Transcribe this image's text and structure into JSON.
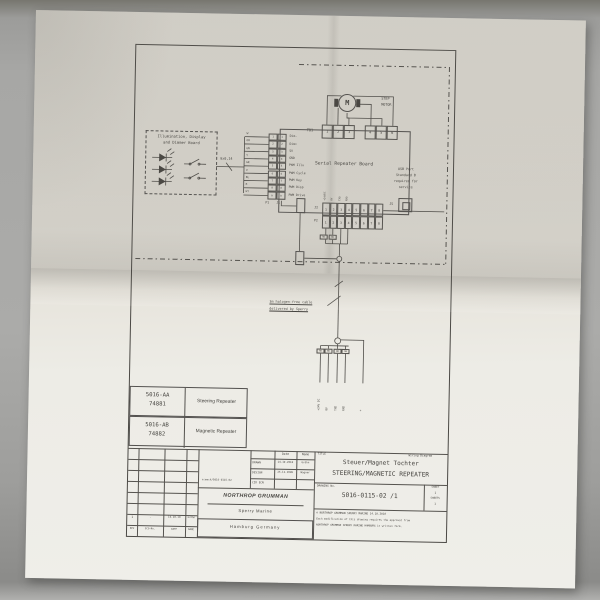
{
  "photo": {
    "desk_color": "#a7a7a5",
    "paper_color": "#e7e4dc",
    "ink_color": "#45433f"
  },
  "schematic": {
    "illumination_board_title_1": "Illumination, Display",
    "illumination_board_title_2": "and Dimmer Board",
    "cable_spec": "9x0,14",
    "strip": {
      "wire_colors": [
        "W",
        "OR",
        "GN",
        "Y",
        "GR",
        "V",
        "BL",
        "R",
        "GY"
      ],
      "left_pins": [
        "1",
        "2",
        "3",
        "4",
        "5",
        "6",
        "7",
        "8",
        "9"
      ],
      "right_pins": [
        "1",
        "2",
        "3",
        "4",
        "5",
        "6",
        "7",
        "8",
        "9"
      ],
      "signals": [
        "Dim-",
        "Dim+",
        "5V",
        "GND",
        "PWM Illu",
        "PWM Cycle",
        "PWM Key",
        "PWM Disp",
        "PWM Drive"
      ],
      "plug": "P1",
      "jack": "J1"
    },
    "board_title": "Serial Repeater Board",
    "motor_symbol": "M",
    "motor_label_1": "STEP",
    "motor_label_2": "MOTOR",
    "tb1_label": "TB1",
    "tb1_pins_left": [
      "1",
      "2",
      "3"
    ],
    "tb1_pins_right": [
      "4",
      "5",
      "6"
    ],
    "usb_note": [
      "USB Port",
      "Standard B",
      "required for",
      "service"
    ],
    "usb_ref": "J5",
    "j2_label": "J2",
    "p2_label": "P2",
    "j2_pins": [
      "1",
      "2",
      "3",
      "4",
      "5",
      "6",
      "7",
      "8"
    ],
    "p2_pins": [
      "1",
      "2",
      "3",
      "4",
      "5",
      "6",
      "7",
      "8"
    ],
    "j2_top_labels": [
      "+24VDC",
      "0V",
      "TXD",
      "RXD",
      "",
      "",
      "",
      ""
    ],
    "wire_tags": [
      "RD",
      "BU"
    ],
    "note_line_1": "3m halogen-free cable",
    "note_line_2": "delivered by Sperry",
    "drop_tags": [
      "RD",
      "BU",
      "WH",
      "GN"
    ],
    "drop_labels": [
      "+24V DC",
      "0V",
      "TXD",
      "RXD",
      "+"
    ]
  },
  "part_table": {
    "rows": [
      {
        "part_no": "5016-AA",
        "item_no": "74881",
        "description": "Steering Repeater"
      },
      {
        "part_no": "5016-AB",
        "item_no": "74882",
        "description": "Magnetic Repeater"
      }
    ]
  },
  "title_block": {
    "title_label": "TITLE",
    "doc_type": "Wiring Diagram",
    "title_de": "Steuer/Magnet Tochter",
    "title_en": "STEERING/MAGNETIC REPEATER",
    "drawing_no_label": "DRAWING No.",
    "drawing_no": "5016-0115-02 /1",
    "sheet_label": "SHEET",
    "sheet_no": "1",
    "sheets_label": "SHEETS",
    "sheets_no": "1",
    "copyright_line_1": "©  NORTHROP GRUMMAN SPERRY MARINE    14.10.2010",
    "copyright_line_2": "Each modification of this drawing requires the approval from",
    "copyright_line_3": "NORTHROP GRUMMAN SPERRY MARINE HAMBURG in written form.",
    "date_header": "Date",
    "name_header": "Name",
    "drawn_label": "DRAWN",
    "drawn_date": "14.10.2010",
    "drawn_name": "Gröhn",
    "design_label": "DESIGN",
    "design_date": "26.11.2009",
    "design_name": "Wagner",
    "cid_label": "CID ECN",
    "file_ref": "e:mech/5016-0115-02",
    "company_logo": "NORTHROP GRUMMAN",
    "company_sub": "Sperry Marine",
    "company_city": "Hamburg Germany",
    "rev_row": {
      "rev": "1",
      "eco": "-",
      "date": "14.10.10",
      "name": "Gröhn"
    },
    "rev_headers": [
      "REV",
      "ECO-No.",
      "DATE",
      "NAME"
    ]
  }
}
